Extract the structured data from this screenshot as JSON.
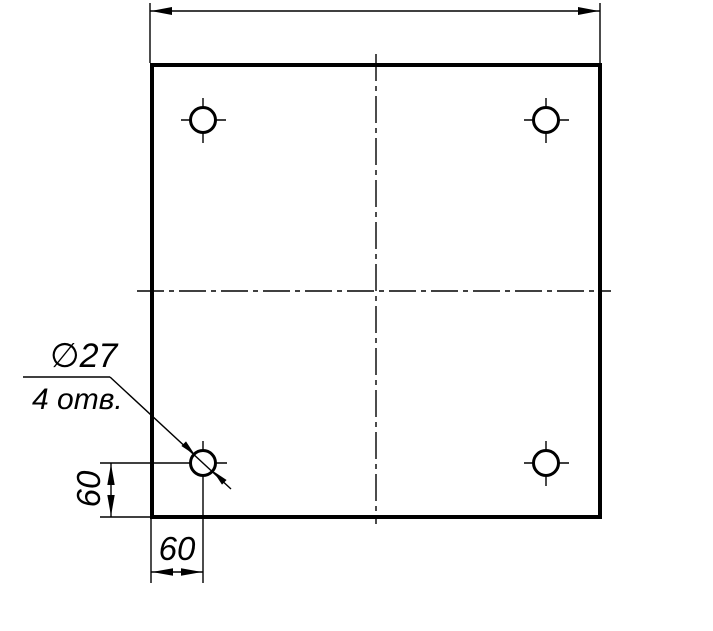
{
  "drawing": {
    "type": "engineering-drawing",
    "annotations": {
      "hole_diameter_label": "∅27",
      "hole_count_label": "4 отв.",
      "left_dimension_label": "60",
      "bottom_dimension_label": "60"
    },
    "values": {
      "hole_diameter": 27,
      "hole_count": 4,
      "hole_offset_from_left_edge": 60,
      "hole_offset_from_bottom_edge": 60
    },
    "holes": [
      "top-left",
      "top-right",
      "bottom-left",
      "bottom-right"
    ],
    "colors": {
      "ink": "#000000",
      "paper": "#ffffff"
    }
  }
}
